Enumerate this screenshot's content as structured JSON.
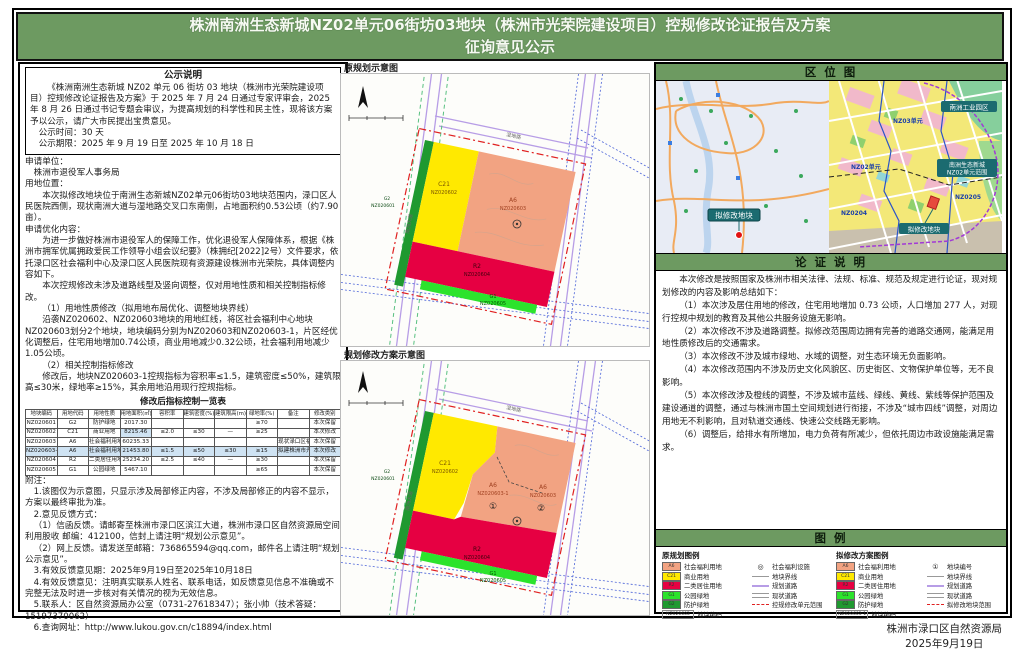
{
  "title": {
    "line1": "株洲南洲生态新城NZ02单元06街坊03地块（株洲市光荣院建设项目）控规修改论证报告及方案",
    "line2": "征询意见公示"
  },
  "colors": {
    "banner_green": "#6d9a61",
    "welfare_salmon": "#f2a382",
    "commercial_yellow": "#ffe900",
    "residential_red": "#e60042",
    "park_green": "#2ce32c",
    "buffer_green": "#1f9930",
    "table_highlight": "#cfe3f3",
    "road_purple": "#b79de6",
    "boundary_red": "#e02020"
  },
  "left": {
    "notice": {
      "header": "公示说明",
      "paragraph": "《株洲南洲生态新城 NZ02 单元 06 街坊 03 地块（株洲市光荣院建设项目）控规修改论证报告及方案》于 2025 年 7 月 24 日通过专家评审会，2025 年 8 月 26 日通过书记专题会审议，为提高规划的科学性和民主性，现将该方案予以公示，请广大市民提出宝贵意见。",
      "time": "公示时间：30 天",
      "period": "公示期限：2025 年 9 月 19 日至 2025 年 10 月 18 日"
    },
    "body": [
      {
        "c": "lb",
        "t": "申请单位："
      },
      {
        "c": "pi",
        "t": "株洲市退役军人事务局"
      },
      {
        "c": "lb",
        "t": "用地位置："
      },
      {
        "c": "p",
        "t": "本次拟修改地块位于南洲生态新城NZ02单元06街坊03地块范围内，渌口区人民医院西侧，现状南洲大道与湿地路交叉口东南侧，占地面积约0.53公顷（约7.90亩）。"
      },
      {
        "c": "lb",
        "t": "申请优化内容："
      },
      {
        "c": "p",
        "t": "为进一步做好株洲市退役军人的保障工作，优化退役军人保障体系，根据《株洲市拥军优属拥政爱民工作领导小组会议纪要》（株拥纪[2022]2号）文件要求，依托渌口区社会福利中心及渌口区人民医院现有资源建设株洲市光荣院，具体调整内容如下。"
      },
      {
        "c": "p",
        "t": "本次控规修改未涉及道路线型及竖向调整，仅对用地性质和相关控制指标修改。"
      },
      {
        "c": "p",
        "t": "（1）用地性质修改（拟用地布局优化、调整地块界线）"
      },
      {
        "c": "p",
        "t": "沿袭NZ020602、NZ020603地块的用地红线，将区社会福利中心地块NZ020603划分2个地块，地块编码分别为NZ020603和NZ020603-1，片区经优化调整后，住宅用地增加0.74公顷，商业用地减少0.32公顷，社会福利用地减少1.05公顷。"
      },
      {
        "c": "p",
        "t": "（2）相关控制指标修改"
      },
      {
        "c": "p",
        "t": "修改后，地块NZ020603-1控规指标为容积率≤1.5，建筑密度≤50%，建筑限高≤30米，绿地率≥15%，其余用地沿用现行控规指标。"
      }
    ],
    "table": {
      "title": "修改后指标控制一览表",
      "headers": [
        "地块编码",
        "用地代码",
        "用地性质",
        "用地面积(㎡)",
        "容积率",
        "建筑密度(%)",
        "建筑限高(m)",
        "绿地率(%)",
        "备注",
        "修改类别"
      ],
      "rows": [
        [
          "NZ020601",
          "G2",
          "防护绿地",
          "2017.30",
          "",
          "",
          "",
          "≥70",
          "",
          "本次保留"
        ],
        [
          "NZ020602",
          "C21",
          "商业用地",
          "8215.46",
          "≤2.0",
          "≤30",
          "—",
          "≥25",
          "",
          "本次修改"
        ],
        [
          "NZ020603",
          "A6",
          "社会福利用地",
          "60235.33",
          "",
          "",
          "",
          "",
          "现状渌口区福利院",
          "本次保留"
        ],
        [
          "NZ020603-1",
          "A6",
          "社会福利用地",
          "21453.80",
          "≤1.5",
          "≤50",
          "≤30",
          "≥15",
          "拟建株洲市光荣院",
          "本次修改"
        ],
        [
          "NZ020604",
          "R2",
          "二类居住用地",
          "25234.20",
          "≤2.5",
          "≤40",
          "—",
          "≥30",
          "",
          "本次保留"
        ],
        [
          "NZ020605",
          "G1",
          "公园绿地",
          "5467.10",
          "",
          "",
          "",
          "≥65",
          "",
          "本次保留"
        ]
      ],
      "highlight_rows": [
        3
      ],
      "highlight_cells": [
        [
          1,
          3
        ]
      ]
    },
    "notes": [
      {
        "c": "lb",
        "t": "附注："
      },
      {
        "c": "n",
        "t": "1.该图仅为示意图，只显示涉及局部修正内容，不涉及局部修正的内容不显示，方案以最终审批为准。"
      },
      {
        "c": "n",
        "t": "2.意见反馈方式："
      },
      {
        "c": "n",
        "t": "（1）信函反馈。请邮寄至株洲市渌口区滨江大道，株洲市渌口区自然资源局空间利用股收 邮编：412100，信封上请注明“规划公示意见”。"
      },
      {
        "c": "n",
        "t": "（2）网上反馈。请发送至邮箱：736865594@qq.com，邮件名上请注明“规划公示意见”。"
      },
      {
        "c": "n",
        "t": "3.有效反馈意见期：2025年9月19日至2025年10月18日"
      },
      {
        "c": "n",
        "t": "4.有效反馈意见：注明真实联系人姓名、联系电话，如反馈意见信息不准确或不完整无法及时进一步核对有关情况的视为无效信息。"
      },
      {
        "c": "n",
        "t": "5.联系人：区自然资源局办公室（0731-27618347）；张小帅（技术答疑：15197370062）"
      },
      {
        "c": "n",
        "t": "6.查询网址：http://www.lukou.gov.cn/c18894/index.html"
      }
    ]
  },
  "middle": {
    "map1_label": "原规划示意图",
    "map2_label": "规划修改方案示意图",
    "parcels": {
      "c21": "C21",
      "c21_id": "NZ020602",
      "a6": "A6",
      "a6_id": "NZ020603",
      "a6b": "A6",
      "a6b_id": "NZ020603-1",
      "r2": "R2",
      "r2_id": "NZ020604",
      "g1": "G1",
      "g1_id": "NZ020605",
      "g2": "G2",
      "g2_id": "NZ020601",
      "n1": "①",
      "n2": "②"
    },
    "roads": {
      "road_left": "南洲大道",
      "road_top": "湿地路"
    }
  },
  "right": {
    "location": {
      "header": "区  位  图",
      "city_callout": "拟修改地块",
      "zoning": {
        "callout_top": "南洲工业园区",
        "callout_mid1": "南洲生态新城",
        "callout_mid2": "NZ02单元范围",
        "callout_parcel": "拟修改地块",
        "unit1": "NZ03单元",
        "unit2": "NZ02单元",
        "unit3": "NZ0204",
        "unit4": "NZ0205"
      }
    },
    "justification": {
      "header": "论 证 说 明",
      "items": [
        "本次修改是按照国家及株洲市相关法律、法规、标准、规范及规定进行论证，现对规划修改的内容及影响总结如下：",
        "（1）本次涉及居住用地的修改，住宅用地增加 0.73 公顷，人口增加 277 人，对现行控规中规划的教育及其他公共服务设施无影响。",
        "（2）本次修改不涉及道路调整。拟修改范围周边拥有完善的道路交通网，能满足用地性质修改后的交通需求。",
        "（3）本次修改不涉及城市绿地、水域的调整，对生态环境无负面影响。",
        "（4）本次修改范围内不涉及历史文化风貌区、历史街区、文物保护单位等，无不良影响。",
        "（5）本次修改涉及橙线的调整，不涉及城市蓝线、绿线、黄线、紫线等保护范围及建设通道的调整，通过与株洲市国土空间规划进行衔接，不涉及“城市四线”调整，对周边用地无不利影响，且对轨道交通线、快速公交线路无影响。",
        "（6）调整后，给排水有所增加，电力负荷有所减少，但依托周边市政设施能满足需求。"
      ]
    },
    "legend": {
      "header": "图  例",
      "groups": [
        {
          "title": "原规划图例",
          "swatches": [
            {
              "color": "#f2a382",
              "code": "A6",
              "label": "社会福利用地"
            },
            {
              "color": "#ffe900",
              "code": "C21",
              "label": "商业用地"
            },
            {
              "color": "#e60042",
              "code": "R2",
              "label": "二类居住用地"
            },
            {
              "color": "#2ce32c",
              "code": "G1",
              "label": "公园绿地"
            },
            {
              "color": "#1f9930",
              "code": "G2",
              "label": "防护绿地"
            }
          ],
          "code_box": "NZ020603",
          "code_label": "地块编码",
          "symbols": [
            {
              "type": "circle",
              "glyph": "◎",
              "label": "社会福利设施"
            },
            {
              "type": "line",
              "style": "thin",
              "label": "地块界线"
            },
            {
              "type": "line",
              "style": "purple",
              "label": "规划道路"
            },
            {
              "type": "line",
              "style": "double",
              "label": "现状道路"
            },
            {
              "type": "line",
              "style": "reddash",
              "label": "控规修改单元范围"
            }
          ]
        },
        {
          "title": "拟修改方案图例",
          "swatches": [
            {
              "color": "#f2a382",
              "code": "A6",
              "label": "社会福利用地"
            },
            {
              "color": "#ffe900",
              "code": "C21",
              "label": "商业用地"
            },
            {
              "color": "#e60042",
              "code": "R2",
              "label": "二类居住用地"
            },
            {
              "color": "#2ce32c",
              "code": "G1",
              "label": "公园绿地"
            },
            {
              "color": "#1f9930",
              "code": "G2",
              "label": "防护绿地"
            }
          ],
          "code_box": "NZ020603-1",
          "code_label": "地块编码",
          "symbols": [
            {
              "type": "circle",
              "glyph": "①",
              "label": "地块编号"
            },
            {
              "type": "line",
              "style": "thin",
              "label": "地块界线"
            },
            {
              "type": "line",
              "style": "purple",
              "label": "规划道路"
            },
            {
              "type": "line",
              "style": "double",
              "label": "现状道路"
            },
            {
              "type": "line",
              "style": "reddash",
              "label": "拟修改地块范围"
            }
          ]
        }
      ]
    }
  },
  "footer": {
    "agency": "株洲市渌口区自然资源局",
    "date": "2025年9月19日"
  }
}
